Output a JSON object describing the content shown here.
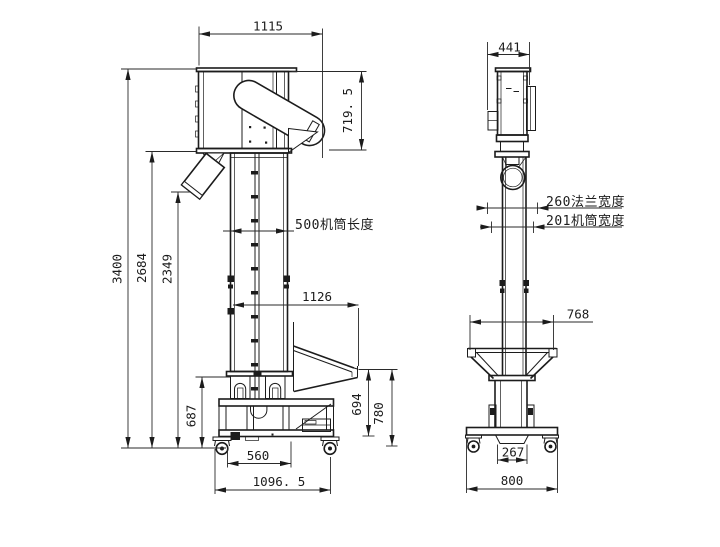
{
  "drawing": {
    "kind": "bucket-elevator dimensional drawing",
    "colors": {
      "line": "#1c1c1c",
      "background": "#ffffff"
    },
    "front": {
      "label": "front view",
      "dims": {
        "head_width": "1115",
        "head_height": "719. 5",
        "barrel_length": "500机筒长度",
        "overall_height": "3400",
        "head_underside_height": "2684",
        "outlet_height": "2349",
        "inlet_span": "1126",
        "frame_height": "687",
        "hopper_lip_to_frame": "694",
        "hopper_lip_to_ground": "780",
        "wheel_span": "560",
        "base_width": "1096. 5"
      }
    },
    "side": {
      "label": "side view",
      "dims": {
        "head_depth": "441",
        "flange_width": "260法兰宽度",
        "barrel_width": "201机筒宽度",
        "hopper_depth": "768",
        "mount_width": "267",
        "base_depth": "800"
      }
    }
  }
}
